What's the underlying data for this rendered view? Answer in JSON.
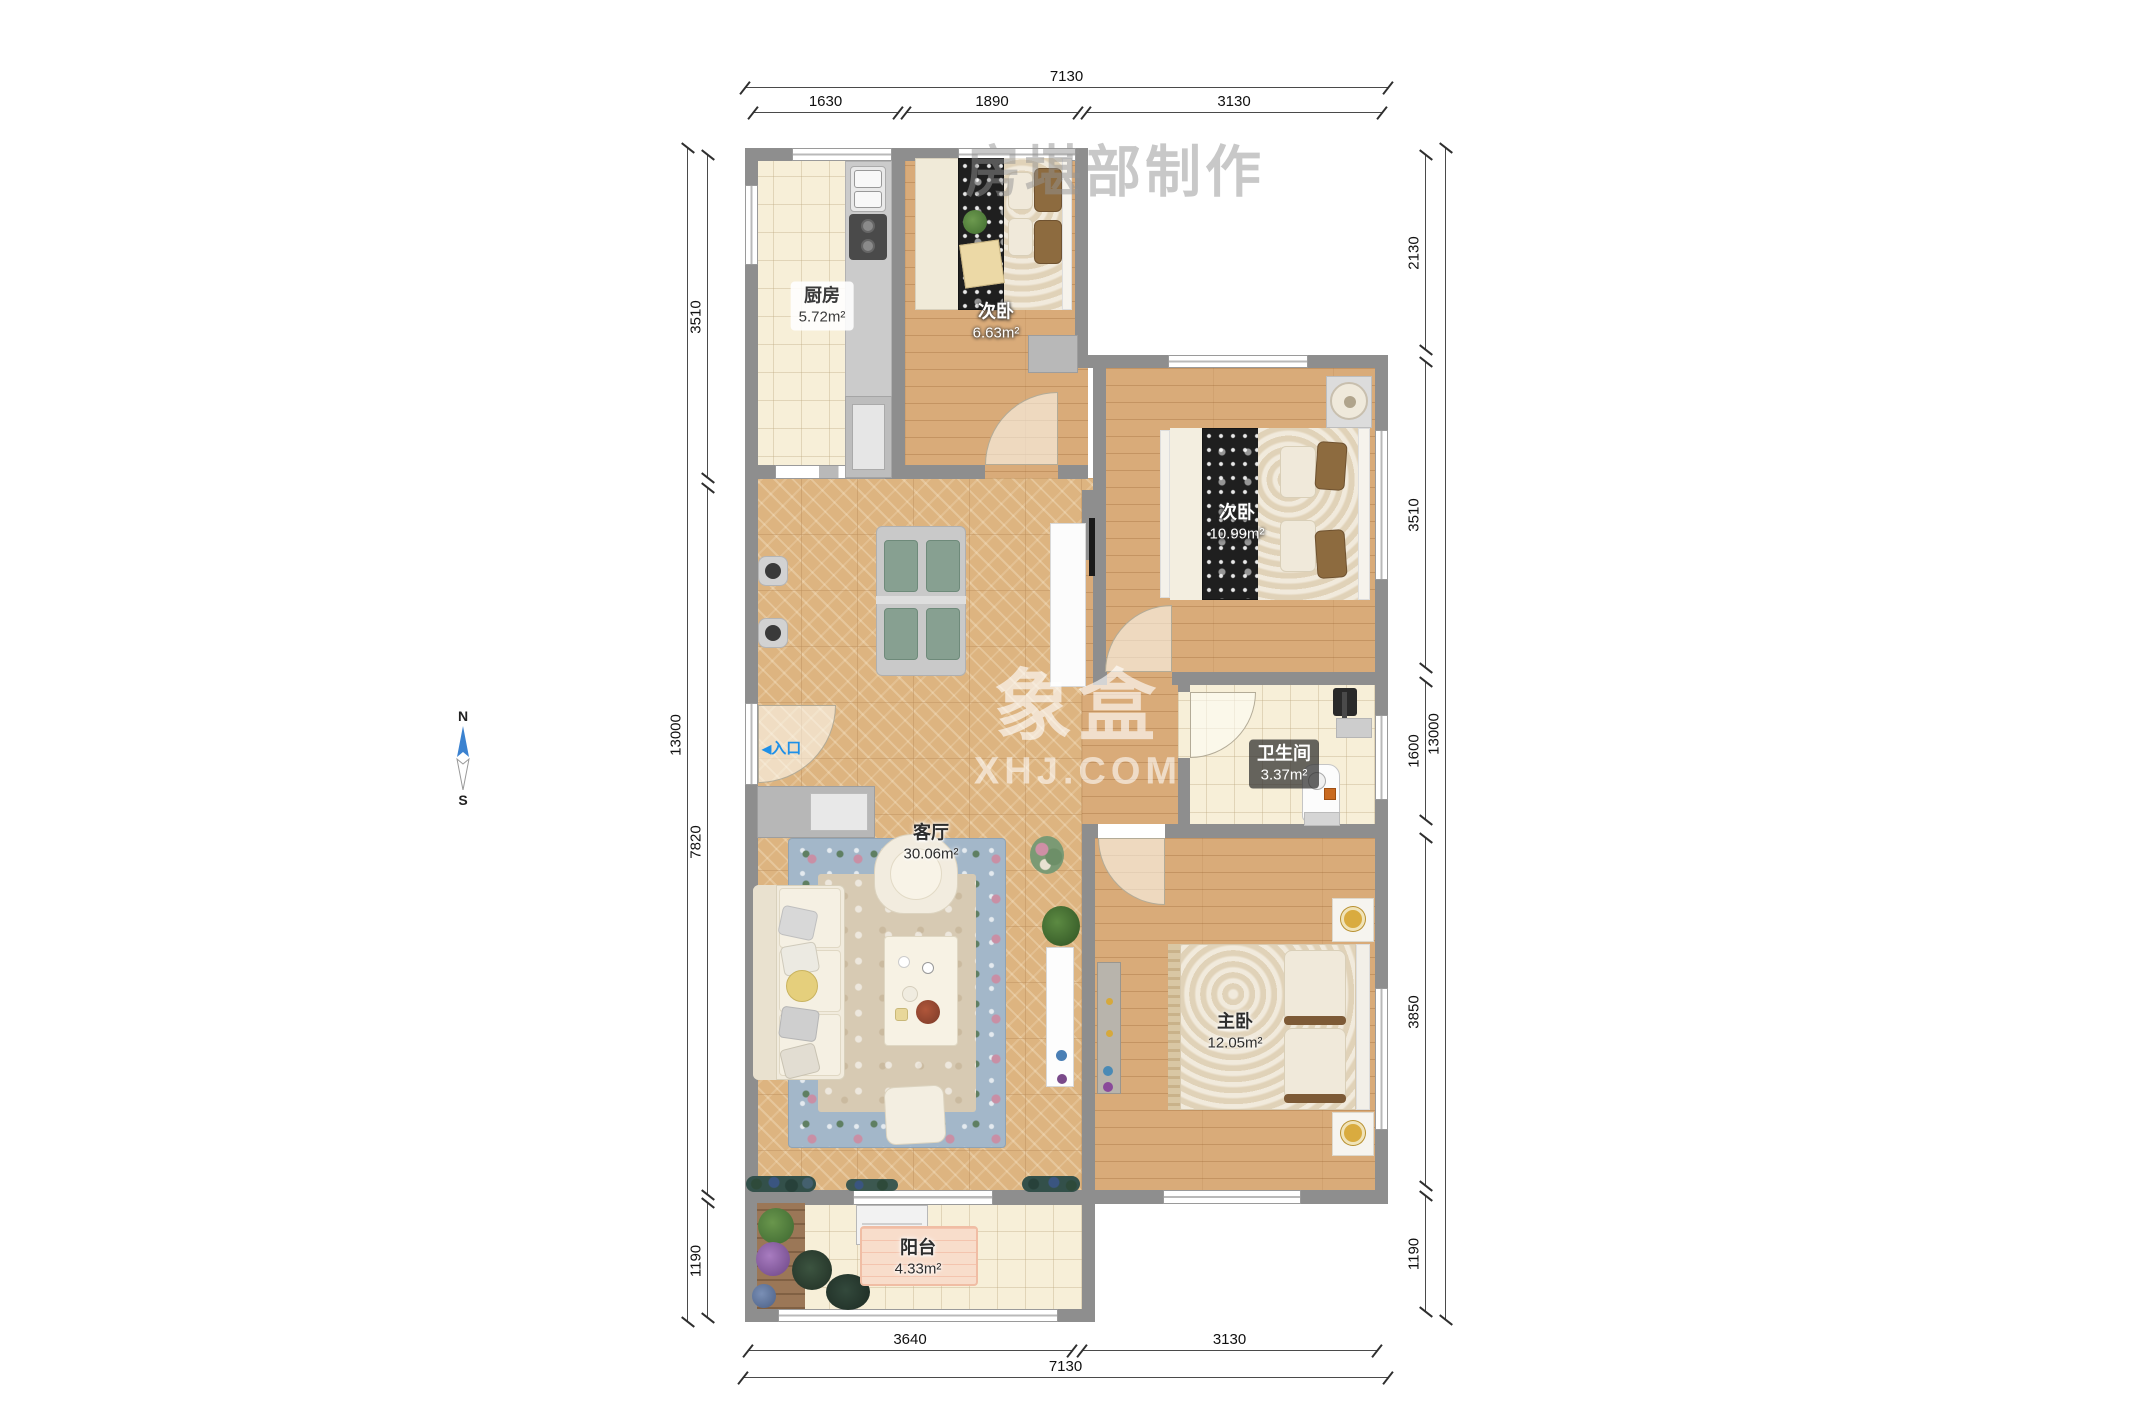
{
  "watermark": {
    "maker": "房堪部制作",
    "logo": "象盒",
    "site": "XHJ.COM"
  },
  "compass": {
    "n": "N",
    "s": "S"
  },
  "entrance": {
    "arrow": "◀",
    "label": "入口"
  },
  "rooms": {
    "kitchen": {
      "name": "厨房",
      "area": "5.72m²"
    },
    "bedroom_small": {
      "name": "次卧",
      "area": "6.63m²"
    },
    "bedroom_mid": {
      "name": "次卧",
      "area": "10.99m²"
    },
    "bathroom": {
      "name": "卫生间",
      "area": "3.37m²"
    },
    "living": {
      "name": "客厅",
      "area": "30.06m²"
    },
    "master": {
      "name": "主卧",
      "area": "12.05m²"
    },
    "balcony": {
      "name": "阳台",
      "area": "4.33m²"
    }
  },
  "dims": {
    "top_total": "7130",
    "top": [
      "1630",
      "1890",
      "3130"
    ],
    "bottom": [
      "3640",
      "3130"
    ],
    "bottom_total": "7130",
    "left": [
      "3510",
      "7820",
      "1190"
    ],
    "left_total": "13000",
    "right": [
      "2130",
      "3510",
      "1600",
      "3850",
      "1190"
    ],
    "right_total": "13000"
  },
  "colors": {
    "wall": "#8e8e8e",
    "accent_blue": "#1e90e8",
    "compass_blue": "#3b82d0",
    "wood": "#d9ab79",
    "tile": "#f7efd8",
    "marble": "#ddb480"
  }
}
